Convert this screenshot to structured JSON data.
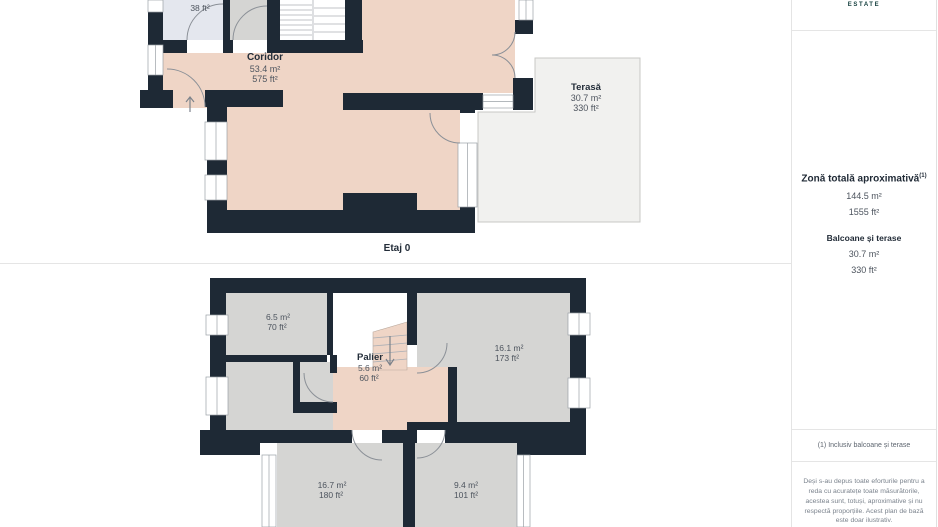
{
  "brand": {
    "logo_text": "ESTATE"
  },
  "colors": {
    "wall": "#1e2935",
    "room_salmon": "#efd5c6",
    "room_gray": "#d5d5d3",
    "room_blue": "#e4e7ee",
    "terrace": "#f1f1ef",
    "label_dark": "#232d39",
    "label_value": "#4d545e",
    "logo_teal": "#16403f"
  },
  "floor0": {
    "caption": "Etaj 0",
    "rooms": {
      "small_room": {
        "area_ft": "38 ft²"
      },
      "coridor": {
        "name": "Coridor",
        "area_m": "53.4 m²",
        "area_ft": "575 ft²"
      },
      "terasa": {
        "name": "Terasă",
        "area_m": "30.7 m²",
        "area_ft": "330 ft²"
      }
    }
  },
  "floor1": {
    "rooms": {
      "room_65": {
        "area_m": "6.5 m²",
        "area_ft": "70 ft²"
      },
      "palier": {
        "name": "Palier",
        "area_m": "5.6 m²",
        "area_ft": "60 ft²"
      },
      "room_161": {
        "area_m": "16.1 m²",
        "area_ft": "173 ft²"
      },
      "room_167": {
        "area_m": "16.7 m²",
        "area_ft": "180 ft²"
      },
      "room_94": {
        "area_m": "9.4 m²",
        "area_ft": "101 ft²"
      }
    }
  },
  "sidebar": {
    "total": {
      "title": "Zonă totală aproximativă",
      "superscript": "(1)",
      "area_m": "144.5 m²",
      "area_ft": "1555 ft²"
    },
    "balconies": {
      "title": "Balcoane și terase",
      "area_m": "30.7 m²",
      "area_ft": "330 ft²"
    },
    "footnote": "(1) Inclusiv balcoane și terase",
    "disclaimer": "Deși s-au depus toate eforturile pentru a reda cu acuratețe toate măsurătorile, acestea sunt, totuși, aproximative și nu respectă proporțiile. Acest plan de bază este doar ilustrativ."
  }
}
